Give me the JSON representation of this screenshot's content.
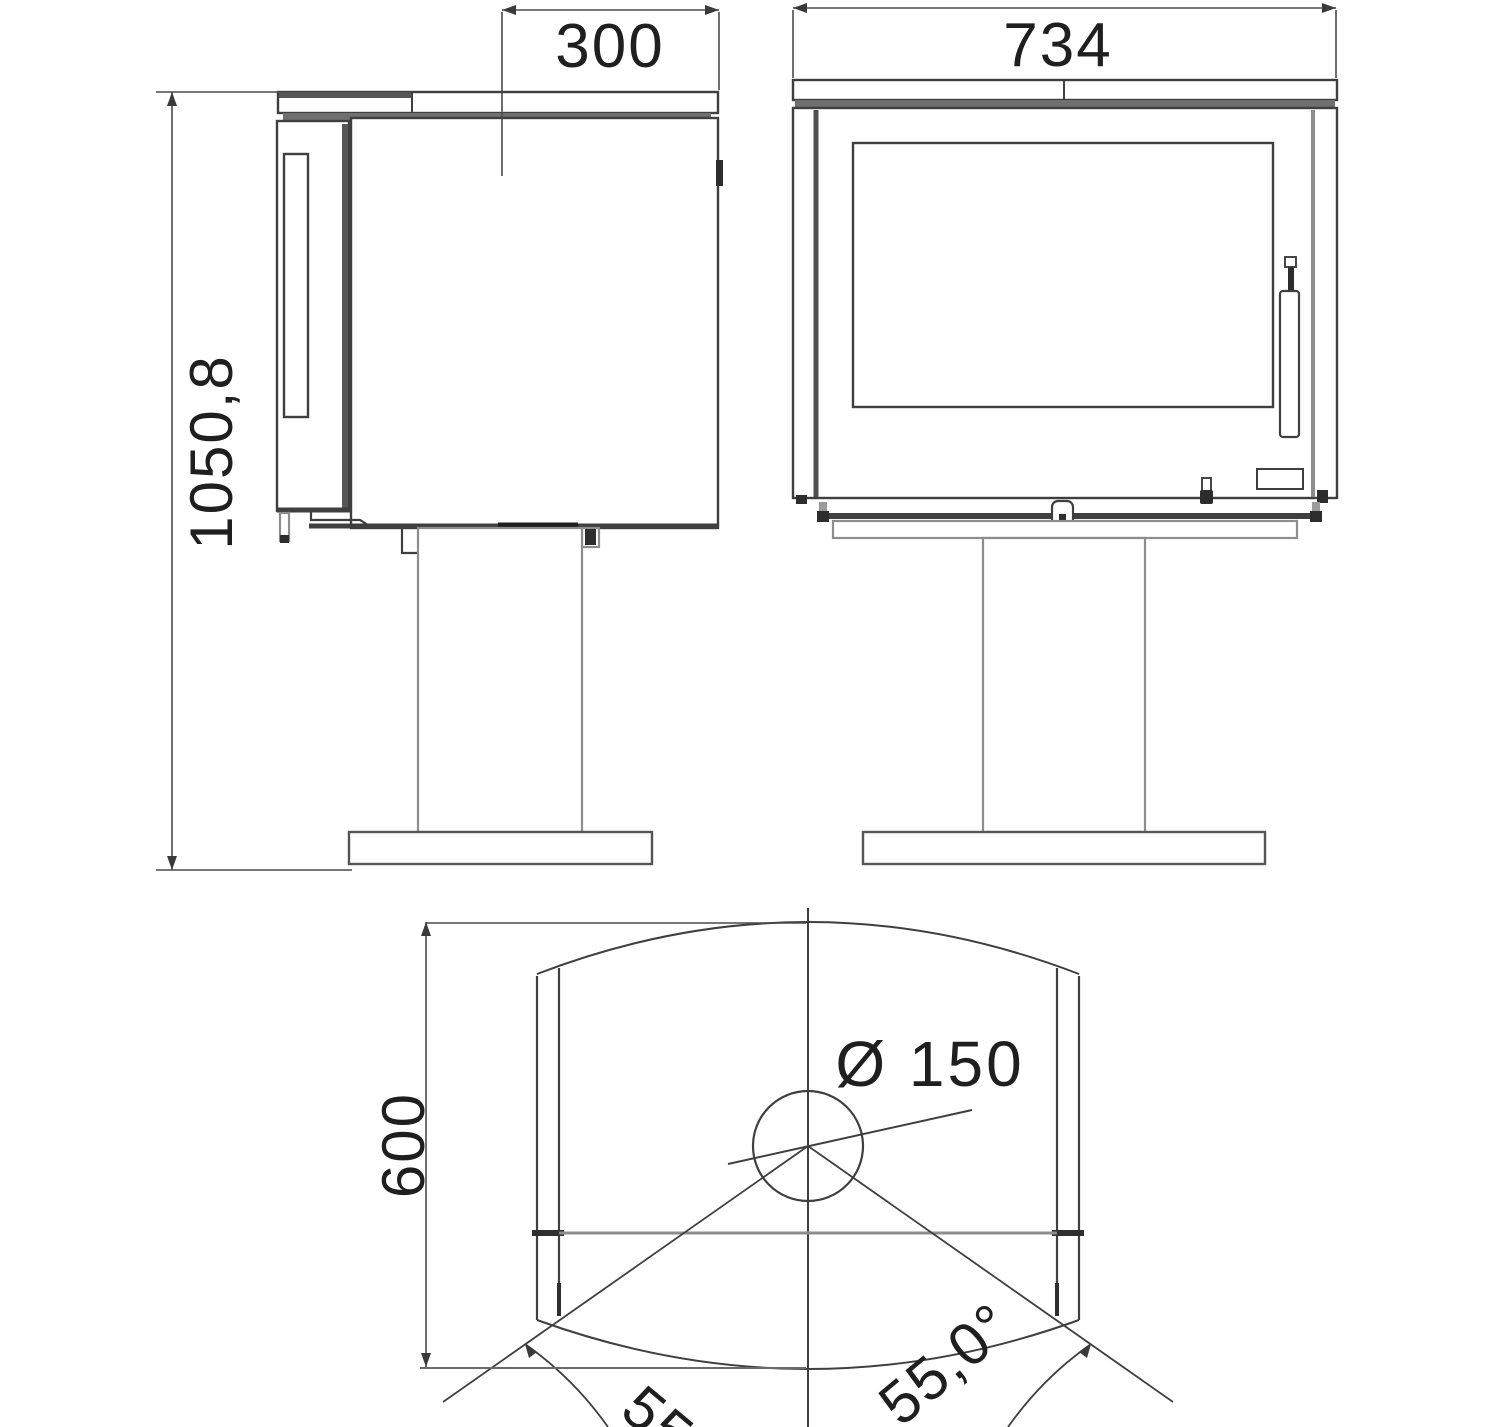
{
  "document": {
    "type": "technical dimension drawing",
    "subject": "wood-burning stove on pedestal: side view, front view and plan view",
    "background": "#ffffff"
  },
  "colors": {
    "line_dark": "#3f3f3f",
    "line_heavy": "#6f6f6f",
    "line_light": "#8d8d8d",
    "text": "#1f1f1f"
  },
  "dimensions": {
    "side_top_depth": "300",
    "front_width": "734",
    "overall_height": "1050,8",
    "plan_depth": "600",
    "flue_diameter": "Ø 150",
    "rotation_angle_left": "55",
    "rotation_angle_right": "55,0°"
  }
}
